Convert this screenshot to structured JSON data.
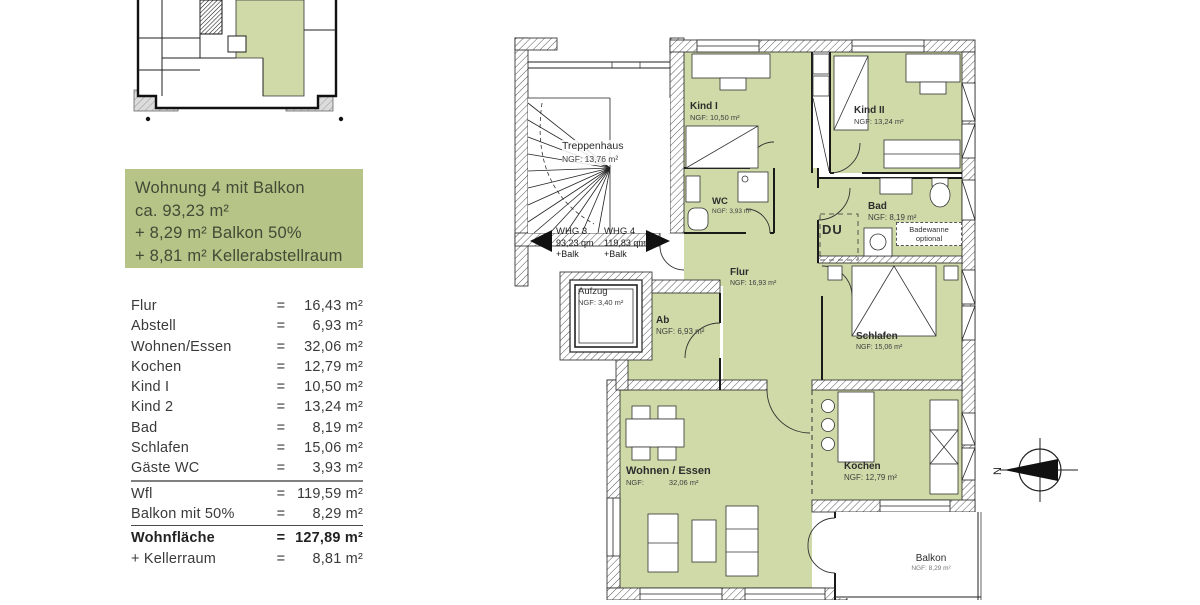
{
  "info_box": {
    "line1": "Wohnung 4 mit Balkon",
    "line2": "ca. 93,23 m²",
    "line3": "+ 8,29 m² Balkon 50%",
    "line4": "+ 8,81 m² Kellerabstellraum"
  },
  "area_table": {
    "rows": [
      {
        "label": "Flur",
        "eq": "=",
        "value": "16,43 m²"
      },
      {
        "label": "Abstell",
        "eq": "=",
        "value": "6,93 m²"
      },
      {
        "label": "Wohnen/Essen",
        "eq": "=",
        "value": "32,06 m²"
      },
      {
        "label": "Kochen",
        "eq": "=",
        "value": "12,79 m²"
      },
      {
        "label": "Kind I",
        "eq": "=",
        "value": "10,50 m²"
      },
      {
        "label": "Kind 2",
        "eq": "=",
        "value": "13,24 m²"
      },
      {
        "label": "Bad",
        "eq": "=",
        "value": "8,19 m²"
      },
      {
        "label": "Schlafen",
        "eq": "=",
        "value": "15,06 m²"
      },
      {
        "label": "Gäste WC",
        "eq": "=",
        "value": "3,93 m²"
      },
      {
        "label": "Wfl",
        "eq": "=",
        "value": "119,59 m²"
      },
      {
        "label": "Balkon mit 50%",
        "eq": "=",
        "value": "8,29 m²"
      },
      {
        "label": "Wohnfläche",
        "eq": "=",
        "value": "127,89 m²"
      },
      {
        "label": "+ Kellerraum",
        "eq": "=",
        "value": "8,81 m²"
      }
    ]
  },
  "plan": {
    "rooms": {
      "treppenhaus": {
        "name": "Treppenhaus",
        "ngf": "NGF: 13,76 m²"
      },
      "aufzug": {
        "name": "Aufzug",
        "ngf": "NGF: 3,40 m²"
      },
      "kind1": {
        "name": "Kind I",
        "ngf": "NGF: 10,50 m²"
      },
      "kind2": {
        "name": "Kind II",
        "ngf": "NGF: 13,24 m²"
      },
      "wc": {
        "name": "WC",
        "ngf": "NGF: 3,93 m²"
      },
      "bad": {
        "name": "Bad",
        "ngf": "NGF: 8,19 m²"
      },
      "flur": {
        "name": "Flur",
        "ngf": "NGF: 16,93 m²"
      },
      "ab": {
        "name": "Ab",
        "ngf": "NGF: 6,93 m²"
      },
      "schlafen": {
        "name": "Schlafen",
        "ngf": "NGF: 15,06 m²"
      },
      "wohnen": {
        "name": "Wohnen / Essen",
        "ngf": "NGF:            32,06 m²"
      },
      "kochen": {
        "name": "Kochen",
        "ngf": "NGF: 12,79 m²"
      },
      "balkon": {
        "name": "Balkon",
        "ngf": "NGF: 8,29 m²"
      }
    },
    "whg3": {
      "name": "WHG 3",
      "area": "93,23 qm",
      "suffix": "+Balk"
    },
    "whg4": {
      "name": "WHG 4",
      "area": "119,83 qm",
      "suffix": "+Balk"
    },
    "du_label": "DU",
    "badewanne_line1": "Badewanne",
    "badewanne_line2": "optional",
    "north_label": "N"
  },
  "colors": {
    "room_green": "#cfdaa8",
    "box_green": "#b6c487"
  }
}
